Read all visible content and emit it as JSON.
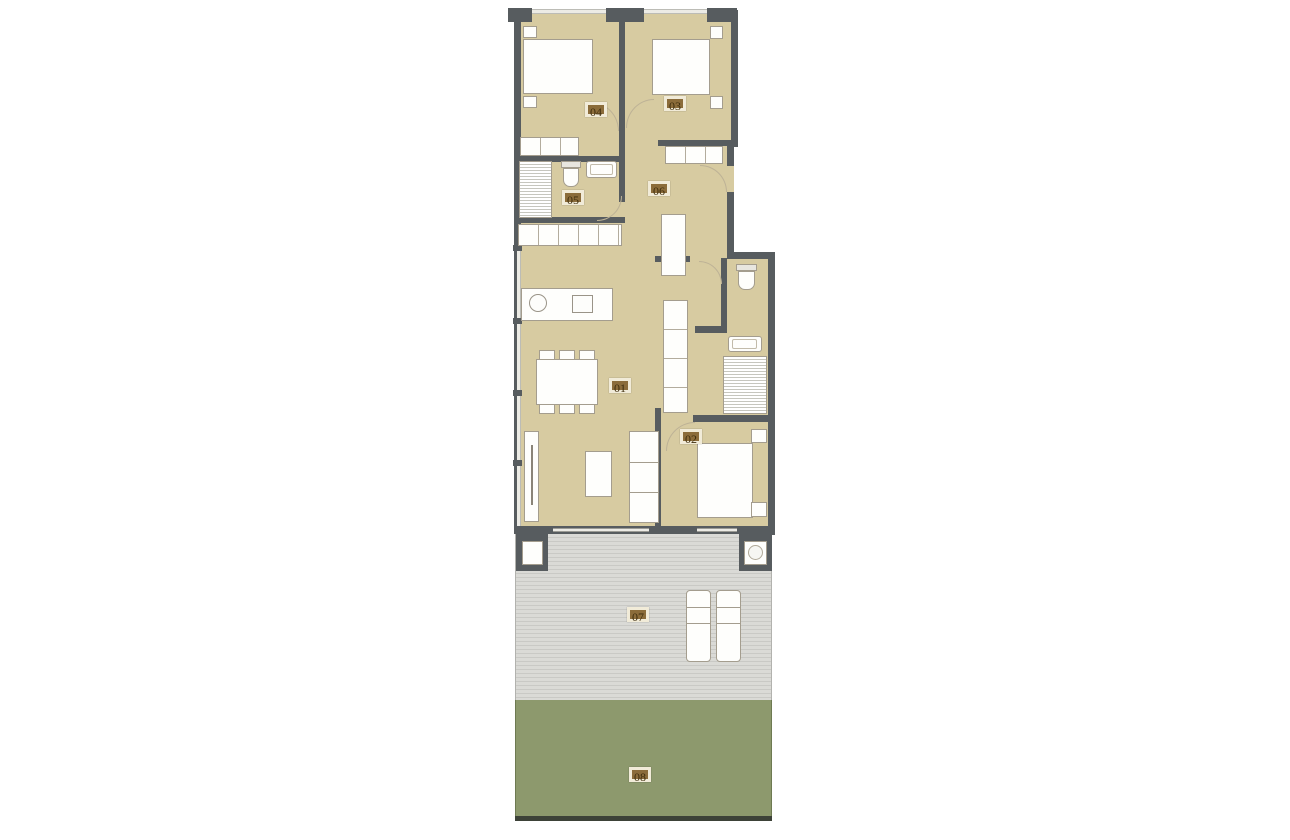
{
  "plan": {
    "labels": [
      {
        "id": "label-01",
        "text": "01"
      },
      {
        "id": "label-02",
        "text": "02"
      },
      {
        "id": "label-03",
        "text": "03"
      },
      {
        "id": "label-04",
        "text": "04"
      },
      {
        "id": "label-05",
        "text": "05"
      },
      {
        "id": "label-06",
        "text": "06"
      },
      {
        "id": "label-07",
        "text": "07"
      },
      {
        "id": "label-08",
        "text": "08"
      }
    ],
    "colors": {
      "page_bg": "#ffffff",
      "wall": "#575c5f",
      "floor": "#d7cba1",
      "furniture_fill": "#fefefc",
      "furniture_border": "#a49d8e",
      "window_glass": "#ecebe5",
      "terrace_bg": "#dadad6",
      "terrace_stripe": "#c9c9c5",
      "garden": "#8d996d",
      "garden_edge": "#3d4238",
      "label_bg": "#8b6c3a",
      "label_border": "#f1ebd8",
      "label_text": "#3e2d0d",
      "door_arc": "#bdb296"
    }
  }
}
